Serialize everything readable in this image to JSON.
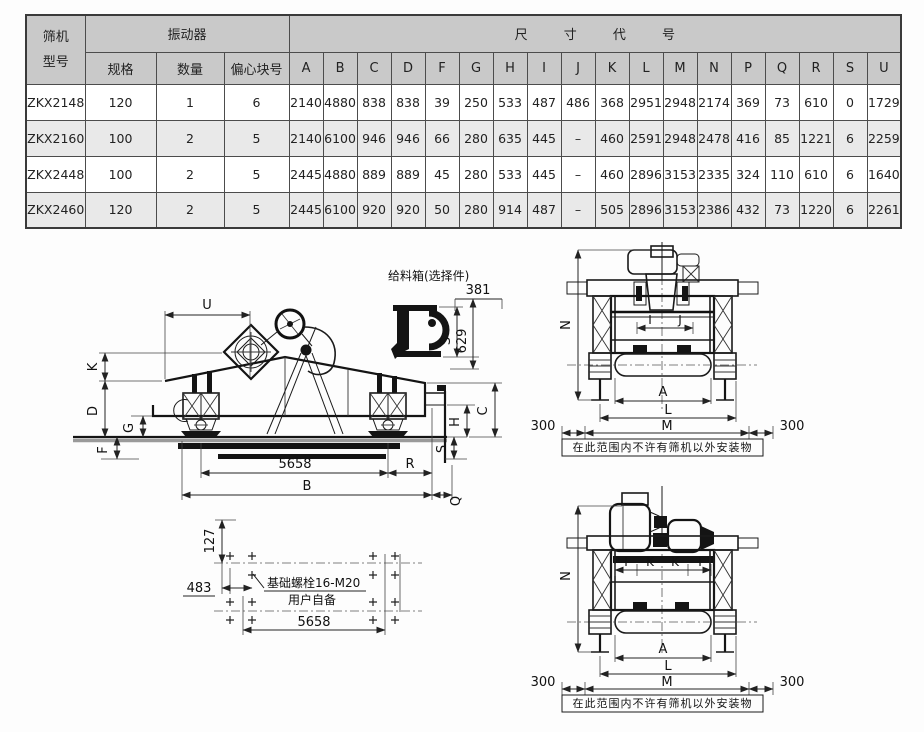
{
  "colors": {
    "paper": "#fdfdfd",
    "ink": "#1a1a1a",
    "table_header_bg": "#c9c9c9",
    "table_alt_row_bg": "#e9e9e9"
  },
  "table": {
    "model_header_line1": "筛机",
    "model_header_line2": "型号",
    "vibrator_header": "振动器",
    "dims_header": "尺 寸 代 号",
    "sub_headers": [
      "规格",
      "数量",
      "偏心块号"
    ],
    "dim_letters": [
      "A",
      "B",
      "C",
      "D",
      "F",
      "G",
      "H",
      "I",
      "J",
      "K",
      "L",
      "M",
      "N",
      "P",
      "Q",
      "R",
      "S",
      "U"
    ],
    "rows": [
      {
        "model": "ZKX2148",
        "spec": "120",
        "qty": "1",
        "block": "6",
        "dims": [
          "2140",
          "4880",
          "838",
          "838",
          "39",
          "250",
          "533",
          "487",
          "486",
          "368",
          "2951",
          "2948",
          "2174",
          "369",
          "73",
          "610",
          "0",
          "1729"
        ]
      },
      {
        "model": "ZKX2160",
        "spec": "100",
        "qty": "2",
        "block": "5",
        "dims": [
          "2140",
          "6100",
          "946",
          "946",
          "66",
          "280",
          "635",
          "445",
          "–",
          "460",
          "2591",
          "2948",
          "2478",
          "416",
          "85",
          "1221",
          "6",
          "2259"
        ]
      },
      {
        "model": "ZKX2448",
        "spec": "100",
        "qty": "2",
        "block": "5",
        "dims": [
          "2445",
          "4880",
          "889",
          "889",
          "45",
          "280",
          "533",
          "445",
          "–",
          "460",
          "2896",
          "3153",
          "2335",
          "324",
          "110",
          "610",
          "6",
          "1640"
        ]
      },
      {
        "model": "ZKX2460",
        "spec": "120",
        "qty": "2",
        "block": "5",
        "dims": [
          "2445",
          "6100",
          "920",
          "920",
          "50",
          "280",
          "914",
          "487",
          "–",
          "505",
          "2896",
          "3153",
          "2386",
          "432",
          "73",
          "1220",
          "6",
          "2261"
        ]
      }
    ]
  },
  "drawings": {
    "side_view": {
      "u": "U",
      "k": "K",
      "d": "D",
      "g": "G",
      "f": "F",
      "base_span": "5658",
      "b": "B",
      "r": "R",
      "q": "Q",
      "s": "S",
      "h": "H",
      "c": "C"
    },
    "feed_box": {
      "title": "给料箱(选择件)",
      "width": "381",
      "s": "S",
      "height": "629"
    },
    "front_view_top": {
      "n": "N",
      "i": "I",
      "j": "J",
      "a": "A",
      "l": "L",
      "m": "M",
      "left_clearance": "300",
      "right_clearance": "300",
      "note": "在此范围内不许有筛机以外安装物"
    },
    "foundation_plan": {
      "row_offset": "127",
      "col_offset": "483",
      "bolt_note_line1": "基础螺栓16-M20",
      "bolt_note_line2": "用户自备",
      "bolt_span": "5658"
    },
    "front_view_bottom": {
      "n": "N",
      "i_left": "I",
      "k_left": "K",
      "k_right": "K",
      "i_right": "I",
      "a": "A",
      "l": "L",
      "m": "M",
      "left_clearance": "300",
      "right_clearance": "300",
      "note": "在此范围内不许有筛机以外安装物"
    }
  }
}
